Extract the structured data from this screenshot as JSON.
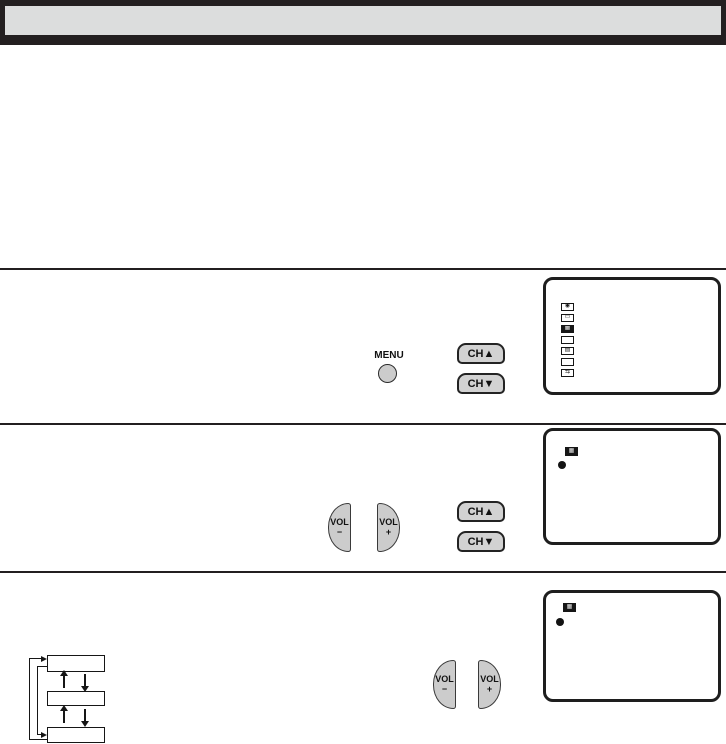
{
  "header": {
    "title": ""
  },
  "colors": {
    "ink": "#231f20",
    "header_fill": "#dcdddd",
    "button_fill": "#d2d2d2",
    "vol_button_fill": "#cccccc",
    "screen_bg": "#ffffff"
  },
  "controls": {
    "menu_label": "MENU",
    "ch_up_label": "CH▲",
    "ch_down_label": "CH▼",
    "vol_minus": {
      "top": "VOL",
      "bottom": "−"
    },
    "vol_plus": {
      "top": "VOL",
      "bottom": "+"
    }
  },
  "screens": [
    {
      "name": "menu-list-screen",
      "selected_index": 2,
      "bullet": "●",
      "icons": [
        {
          "glyph": "◉"
        },
        {
          "glyph": "▭"
        },
        {
          "glyph": "▦"
        },
        {
          "glyph": ""
        },
        {
          "glyph": "▤"
        },
        {
          "glyph": ""
        },
        {
          "glyph": "⇆"
        }
      ]
    },
    {
      "name": "submenu-screen",
      "icon_glyph": "▦",
      "bullet": "●"
    },
    {
      "name": "adjust-screen",
      "icon_glyph": "▦",
      "bullet": "●"
    }
  ],
  "flow_diagram": {
    "boxes": [
      "",
      "",
      ""
    ],
    "cycle": "bidirectional"
  }
}
